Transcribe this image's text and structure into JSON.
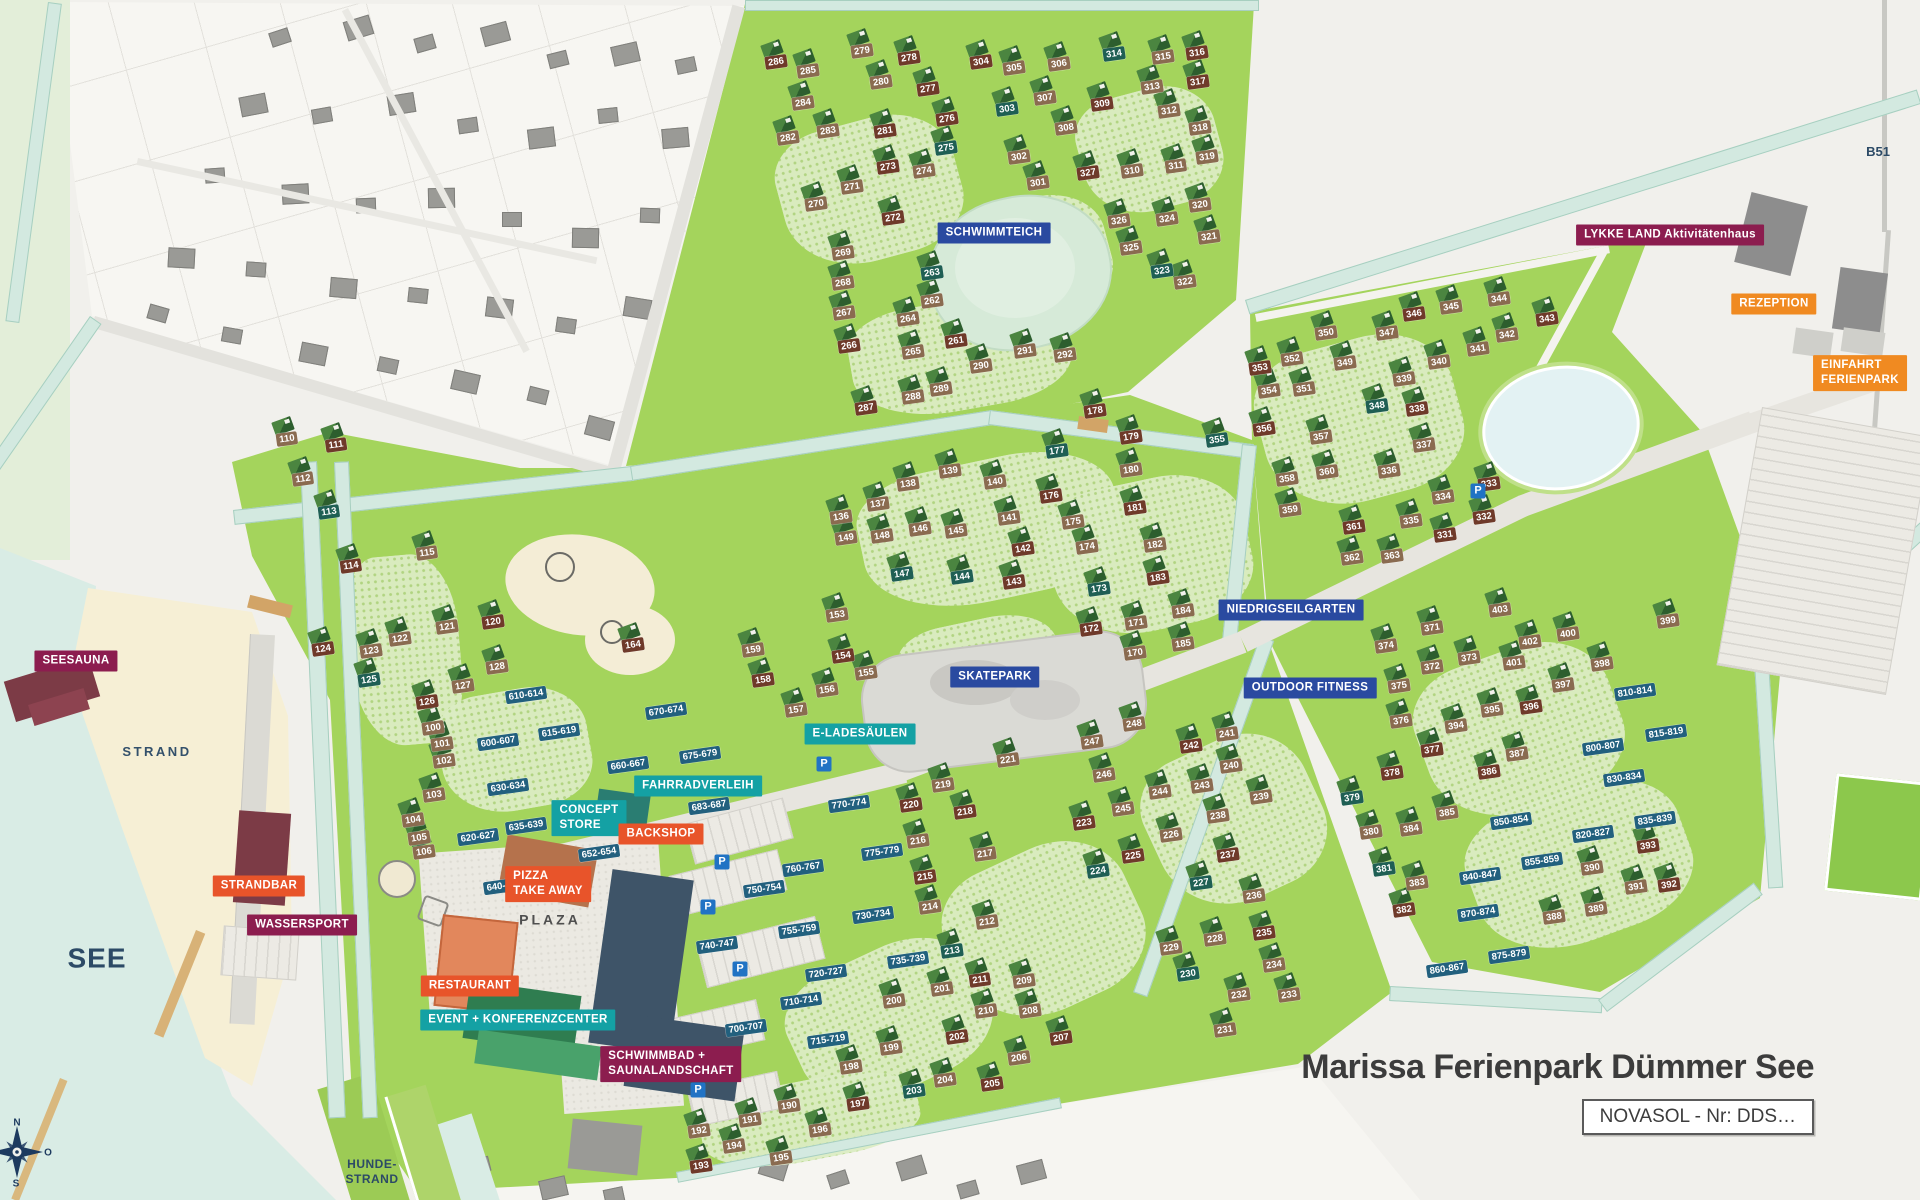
{
  "title": {
    "text": "Marissa Ferienpark Dümmer See"
  },
  "novasol_label": "NOVASOL - Nr: DDS…",
  "compass": {
    "north": "N",
    "east": "O",
    "south": "S"
  },
  "parking_label": "P",
  "colors": {
    "magenta": "#8c1d4f",
    "orange": "#f08a21",
    "red": "#e8542a",
    "teal": "#14a1a4",
    "blue": "#2a4aa0",
    "range_label": "#22607e",
    "house_tan": "#8a6b50",
    "house_redbrown": "#6f3a2a",
    "house_teal": "#1f5f54",
    "park_green": "#a4d45c",
    "water": "#d9ece5",
    "sand": "#f6efd5",
    "navy_text": "#2c4a66"
  },
  "area_labels": [
    {
      "name": "strand",
      "text": "STRAND",
      "x": 157,
      "y": 752,
      "size": 13,
      "ls": 2.5,
      "color": "#33506b"
    },
    {
      "name": "see",
      "text": "SEE",
      "x": 97,
      "y": 958,
      "size": 28,
      "ls": 1,
      "color": "#2c4a66"
    },
    {
      "name": "hunde-strand",
      "text": "HUNDE-\nSTRAND",
      "x": 372,
      "y": 1172,
      "size": 12,
      "ls": 0.5,
      "color": "#2c4a66"
    },
    {
      "name": "plaza",
      "text": "PLAZA",
      "x": 550,
      "y": 920,
      "size": 14,
      "ls": 3,
      "color": "#4f4f4f"
    },
    {
      "name": "b51",
      "text": "B51",
      "x": 1878,
      "y": 152,
      "size": 13,
      "ls": 0,
      "color": "#2c4a66"
    }
  ],
  "facilities": [
    {
      "label": "SEESAUNA",
      "x": 76,
      "y": 661,
      "type": "magenta"
    },
    {
      "label": "STRANDBAR",
      "x": 259,
      "y": 886,
      "type": "red"
    },
    {
      "label": "WASSERSPORT",
      "x": 302,
      "y": 925,
      "type": "magenta"
    },
    {
      "label": "CONCEPT\nSTORE",
      "x": 589,
      "y": 818,
      "type": "teal"
    },
    {
      "label": "BACKSHOP",
      "x": 661,
      "y": 834,
      "type": "red"
    },
    {
      "label": "PIZZA\nTAKE AWAY",
      "x": 548,
      "y": 884,
      "type": "red"
    },
    {
      "label": "RESTAURANT",
      "x": 470,
      "y": 986,
      "type": "red"
    },
    {
      "label": "EVENT + KONFERENZCENTER",
      "x": 518,
      "y": 1020,
      "type": "teal"
    },
    {
      "label": "SCHWIMMBAD +\nSAUNALANDSCHAFT",
      "x": 671,
      "y": 1064,
      "type": "magenta"
    },
    {
      "label": "FAHRRADVERLEIH",
      "x": 698,
      "y": 786,
      "type": "teal"
    },
    {
      "label": "E-LADESÄULEN",
      "x": 860,
      "y": 734,
      "type": "teal"
    },
    {
      "label": "SKATEPARK",
      "x": 995,
      "y": 677,
      "type": "blue"
    },
    {
      "label": "SCHWIMMTEICH",
      "x": 994,
      "y": 233,
      "type": "blue"
    },
    {
      "label": "NIEDRIGSEILGARTEN",
      "x": 1291,
      "y": 610,
      "type": "blue"
    },
    {
      "label": "OUTDOOR FITNESS",
      "x": 1310,
      "y": 688,
      "type": "blue"
    },
    {
      "label": "LYKKE LAND Aktivitätenhaus",
      "x": 1670,
      "y": 235,
      "type": "magenta"
    },
    {
      "label": "REZEPTION",
      "x": 1774,
      "y": 304,
      "type": "orange"
    },
    {
      "label": "EINFAHRT\nFERIENPARK",
      "x": 1860,
      "y": 373,
      "type": "orange"
    }
  ],
  "parking": [
    {
      "x": 824,
      "y": 764
    },
    {
      "x": 722,
      "y": 862
    },
    {
      "x": 708,
      "y": 907
    },
    {
      "x": 740,
      "y": 969
    },
    {
      "x": 698,
      "y": 1090
    },
    {
      "x": 1478,
      "y": 491
    }
  ],
  "ranges": [
    [
      "600-607",
      498,
      742
    ],
    [
      "610-614",
      526,
      695
    ],
    [
      "615-619",
      559,
      732
    ],
    [
      "620-627",
      478,
      837
    ],
    [
      "630-634",
      508,
      787
    ],
    [
      "635-639",
      526,
      826
    ],
    [
      "640-647",
      504,
      886
    ],
    [
      "652-654",
      599,
      853
    ],
    [
      "660-667",
      628,
      765
    ],
    [
      "670-674",
      666,
      711
    ],
    [
      "675-679",
      700,
      755
    ],
    [
      "683-687",
      709,
      806
    ],
    [
      "700-707",
      746,
      1028
    ],
    [
      "710-714",
      801,
      1001
    ],
    [
      "715-719",
      828,
      1040
    ],
    [
      "720-727",
      826,
      973
    ],
    [
      "730-734",
      873,
      915
    ],
    [
      "735-739",
      908,
      960
    ],
    [
      "740-747",
      717,
      945
    ],
    [
      "750-754",
      764,
      889
    ],
    [
      "755-759",
      799,
      930
    ],
    [
      "760-767",
      803,
      868
    ],
    [
      "770-774",
      849,
      804
    ],
    [
      "775-779",
      882,
      852
    ],
    [
      "800-807",
      1603,
      747
    ],
    [
      "810-814",
      1635,
      692
    ],
    [
      "815-819",
      1666,
      733
    ],
    [
      "820-827",
      1593,
      834
    ],
    [
      "830-834",
      1624,
      778
    ],
    [
      "835-839",
      1655,
      820
    ],
    [
      "840-847",
      1480,
      876
    ],
    [
      "850-854",
      1511,
      821
    ],
    [
      "855-859",
      1542,
      861
    ],
    [
      "860-867",
      1447,
      969
    ],
    [
      "870-874",
      1478,
      913
    ],
    [
      "875-879",
      1509,
      955
    ]
  ],
  "houses": [
    [
      "100",
      433,
      728,
      "b"
    ],
    [
      "101",
      442,
      744,
      "b"
    ],
    [
      "102",
      444,
      761,
      "b"
    ],
    [
      "103",
      434,
      795,
      "b"
    ],
    [
      "104",
      413,
      820,
      "b"
    ],
    [
      "105",
      419,
      838,
      "b"
    ],
    [
      "106",
      424,
      852,
      "b"
    ],
    [
      "110",
      287,
      439,
      "b"
    ],
    [
      "111",
      336,
      445,
      "r"
    ],
    [
      "112",
      303,
      479,
      "b"
    ],
    [
      "113",
      329,
      512,
      "t"
    ],
    [
      "114",
      351,
      566,
      "r"
    ],
    [
      "115",
      427,
      553,
      "b"
    ],
    [
      "120",
      493,
      622,
      "r"
    ],
    [
      "121",
      447,
      627,
      "b"
    ],
    [
      "122",
      400,
      639,
      "b"
    ],
    [
      "123",
      371,
      651,
      "b"
    ],
    [
      "124",
      323,
      649,
      "r"
    ],
    [
      "125",
      369,
      680,
      "t"
    ],
    [
      "126",
      427,
      702,
      "r"
    ],
    [
      "127",
      463,
      686,
      "b"
    ],
    [
      "128",
      497,
      667,
      "b"
    ],
    [
      "136",
      841,
      517,
      "b"
    ],
    [
      "137",
      878,
      504,
      "b"
    ],
    [
      "138",
      908,
      484,
      "b"
    ],
    [
      "139",
      950,
      471,
      "b"
    ],
    [
      "140",
      995,
      482,
      "b"
    ],
    [
      "141",
      1009,
      518,
      "b"
    ],
    [
      "142",
      1023,
      549,
      "r"
    ],
    [
      "143",
      1014,
      582,
      "r"
    ],
    [
      "144",
      962,
      577,
      "t"
    ],
    [
      "145",
      956,
      531,
      "b"
    ],
    [
      "146",
      920,
      529,
      "b"
    ],
    [
      "147",
      902,
      574,
      "t"
    ],
    [
      "148",
      882,
      536,
      "b"
    ],
    [
      "149",
      846,
      538,
      "b"
    ],
    [
      "153",
      837,
      615,
      "b"
    ],
    [
      "154",
      843,
      656,
      "r"
    ],
    [
      "155",
      866,
      673,
      "b"
    ],
    [
      "156",
      827,
      690,
      "b"
    ],
    [
      "157",
      796,
      710,
      "b"
    ],
    [
      "158",
      763,
      680,
      "r"
    ],
    [
      "159",
      753,
      650,
      "b"
    ],
    [
      "164",
      633,
      645,
      "r"
    ],
    [
      "170",
      1135,
      653,
      "b"
    ],
    [
      "171",
      1136,
      623,
      "b"
    ],
    [
      "172",
      1091,
      629,
      "r"
    ],
    [
      "173",
      1099,
      589,
      "t"
    ],
    [
      "174",
      1087,
      547,
      "b"
    ],
    [
      "175",
      1073,
      522,
      "b"
    ],
    [
      "176",
      1051,
      496,
      "r"
    ],
    [
      "177",
      1057,
      451,
      "t"
    ],
    [
      "178",
      1095,
      411,
      "r"
    ],
    [
      "179",
      1131,
      437,
      "r"
    ],
    [
      "180",
      1131,
      470,
      "b"
    ],
    [
      "181",
      1135,
      508,
      "r"
    ],
    [
      "182",
      1155,
      545,
      "b"
    ],
    [
      "183",
      1158,
      578,
      "r"
    ],
    [
      "184",
      1183,
      611,
      "b"
    ],
    [
      "185",
      1183,
      644,
      "b"
    ],
    [
      "190",
      789,
      1106,
      "b"
    ],
    [
      "191",
      750,
      1120,
      "b"
    ],
    [
      "192",
      699,
      1131,
      "b"
    ],
    [
      "193",
      701,
      1166,
      "r"
    ],
    [
      "194",
      734,
      1146,
      "b"
    ],
    [
      "195",
      781,
      1158,
      "b"
    ],
    [
      "196",
      820,
      1130,
      "b"
    ],
    [
      "197",
      858,
      1104,
      "r"
    ],
    [
      "198",
      851,
      1067,
      "b"
    ],
    [
      "199",
      891,
      1048,
      "b"
    ],
    [
      "200",
      894,
      1001,
      "b"
    ],
    [
      "201",
      942,
      989,
      "b"
    ],
    [
      "202",
      957,
      1037,
      "r"
    ],
    [
      "203",
      914,
      1091,
      "t"
    ],
    [
      "204",
      945,
      1080,
      "b"
    ],
    [
      "205",
      992,
      1084,
      "r"
    ],
    [
      "206",
      1019,
      1058,
      "b"
    ],
    [
      "207",
      1061,
      1038,
      "r"
    ],
    [
      "208",
      1030,
      1011,
      "b"
    ],
    [
      "209",
      1024,
      981,
      "b"
    ],
    [
      "210",
      986,
      1011,
      "b"
    ],
    [
      "211",
      980,
      980,
      "r"
    ],
    [
      "212",
      987,
      922,
      "b"
    ],
    [
      "213",
      952,
      951,
      "t"
    ],
    [
      "214",
      930,
      907,
      "b"
    ],
    [
      "215",
      925,
      877,
      "r"
    ],
    [
      "216",
      918,
      841,
      "b"
    ],
    [
      "217",
      985,
      854,
      "b"
    ],
    [
      "218",
      965,
      812,
      "r"
    ],
    [
      "219",
      943,
      785,
      "b"
    ],
    [
      "220",
      911,
      805,
      "r"
    ],
    [
      "221",
      1008,
      760,
      "b"
    ],
    [
      "223",
      1084,
      823,
      "r"
    ],
    [
      "224",
      1098,
      871,
      "t"
    ],
    [
      "225",
      1133,
      856,
      "r"
    ],
    [
      "226",
      1171,
      835,
      "b"
    ],
    [
      "227",
      1201,
      883,
      "t"
    ],
    [
      "228",
      1215,
      939,
      "b"
    ],
    [
      "229",
      1171,
      948,
      "b"
    ],
    [
      "230",
      1188,
      974,
      "t"
    ],
    [
      "231",
      1225,
      1030,
      "b"
    ],
    [
      "232",
      1239,
      995,
      "b"
    ],
    [
      "233",
      1289,
      995,
      "b"
    ],
    [
      "234",
      1274,
      965,
      "b"
    ],
    [
      "235",
      1264,
      933,
      "r"
    ],
    [
      "236",
      1254,
      896,
      "b"
    ],
    [
      "237",
      1228,
      855,
      "r"
    ],
    [
      "238",
      1218,
      816,
      "b"
    ],
    [
      "239",
      1261,
      797,
      "b"
    ],
    [
      "240",
      1231,
      766,
      "b"
    ],
    [
      "241",
      1227,
      734,
      "b"
    ],
    [
      "242",
      1191,
      746,
      "r"
    ],
    [
      "243",
      1202,
      786,
      "b"
    ],
    [
      "244",
      1160,
      792,
      "b"
    ],
    [
      "245",
      1123,
      809,
      "b"
    ],
    [
      "246",
      1104,
      775,
      "b"
    ],
    [
      "247",
      1092,
      742,
      "b"
    ],
    [
      "248",
      1134,
      724,
      "b"
    ],
    [
      "261",
      956,
      341,
      "r"
    ],
    [
      "262",
      932,
      301,
      "b"
    ],
    [
      "263",
      932,
      273,
      "t"
    ],
    [
      "264",
      908,
      319,
      "b"
    ],
    [
      "265",
      913,
      352,
      "b"
    ],
    [
      "266",
      849,
      346,
      "r"
    ],
    [
      "267",
      844,
      313,
      "b"
    ],
    [
      "268",
      843,
      283,
      "b"
    ],
    [
      "269",
      843,
      253,
      "b"
    ],
    [
      "270",
      816,
      204,
      "b"
    ],
    [
      "271",
      852,
      187,
      "b"
    ],
    [
      "272",
      893,
      218,
      "r"
    ],
    [
      "273",
      888,
      167,
      "r"
    ],
    [
      "274",
      924,
      171,
      "b"
    ],
    [
      "275",
      946,
      148,
      "t"
    ],
    [
      "276",
      947,
      119,
      "r"
    ],
    [
      "277",
      928,
      89,
      "r"
    ],
    [
      "278",
      909,
      58,
      "r"
    ],
    [
      "279",
      862,
      51,
      "b"
    ],
    [
      "280",
      881,
      82,
      "b"
    ],
    [
      "281",
      885,
      131,
      "r"
    ],
    [
      "282",
      788,
      138,
      "b"
    ],
    [
      "283",
      828,
      131,
      "b"
    ],
    [
      "284",
      803,
      103,
      "b"
    ],
    [
      "285",
      808,
      71,
      "b"
    ],
    [
      "286",
      776,
      62,
      "r"
    ],
    [
      "287",
      866,
      408,
      "r"
    ],
    [
      "288",
      913,
      397,
      "b"
    ],
    [
      "289",
      941,
      389,
      "b"
    ],
    [
      "290",
      981,
      366,
      "b"
    ],
    [
      "291",
      1025,
      351,
      "b"
    ],
    [
      "292",
      1065,
      355,
      "b"
    ],
    [
      "301",
      1038,
      183,
      "b"
    ],
    [
      "302",
      1019,
      157,
      "b"
    ],
    [
      "303",
      1007,
      109,
      "t"
    ],
    [
      "304",
      981,
      62,
      "r"
    ],
    [
      "305",
      1014,
      68,
      "b"
    ],
    [
      "306",
      1059,
      64,
      "b"
    ],
    [
      "307",
      1045,
      98,
      "b"
    ],
    [
      "308",
      1066,
      128,
      "b"
    ],
    [
      "309",
      1102,
      104,
      "r"
    ],
    [
      "310",
      1132,
      171,
      "b"
    ],
    [
      "311",
      1176,
      166,
      "b"
    ],
    [
      "312",
      1169,
      111,
      "b"
    ],
    [
      "313",
      1152,
      87,
      "b"
    ],
    [
      "314",
      1114,
      54,
      "t"
    ],
    [
      "315",
      1163,
      57,
      "b"
    ],
    [
      "316",
      1197,
      53,
      "r"
    ],
    [
      "317",
      1198,
      82,
      "r"
    ],
    [
      "318",
      1200,
      128,
      "b"
    ],
    [
      "319",
      1207,
      157,
      "b"
    ],
    [
      "320",
      1200,
      205,
      "b"
    ],
    [
      "321",
      1209,
      237,
      "b"
    ],
    [
      "322",
      1185,
      282,
      "b"
    ],
    [
      "323",
      1162,
      271,
      "t"
    ],
    [
      "324",
      1167,
      219,
      "b"
    ],
    [
      "325",
      1131,
      248,
      "b"
    ],
    [
      "326",
      1119,
      221,
      "b"
    ],
    [
      "327",
      1088,
      173,
      "r"
    ],
    [
      "331",
      1445,
      535,
      "r"
    ],
    [
      "332",
      1484,
      517,
      "r"
    ],
    [
      "333",
      1489,
      484,
      "r"
    ],
    [
      "334",
      1443,
      497,
      "b"
    ],
    [
      "335",
      1411,
      521,
      "b"
    ],
    [
      "336",
      1389,
      471,
      "b"
    ],
    [
      "337",
      1424,
      445,
      "b"
    ],
    [
      "338",
      1417,
      409,
      "r"
    ],
    [
      "339",
      1404,
      379,
      "b"
    ],
    [
      "340",
      1439,
      362,
      "b"
    ],
    [
      "341",
      1478,
      349,
      "b"
    ],
    [
      "342",
      1507,
      335,
      "b"
    ],
    [
      "343",
      1547,
      319,
      "r"
    ],
    [
      "344",
      1499,
      299,
      "b"
    ],
    [
      "345",
      1451,
      307,
      "b"
    ],
    [
      "346",
      1414,
      314,
      "r"
    ],
    [
      "347",
      1387,
      333,
      "b"
    ],
    [
      "348",
      1377,
      406,
      "t"
    ],
    [
      "349",
      1345,
      363,
      "b"
    ],
    [
      "350",
      1326,
      333,
      "b"
    ],
    [
      "351",
      1304,
      389,
      "b"
    ],
    [
      "352",
      1292,
      359,
      "b"
    ],
    [
      "353",
      1260,
      368,
      "r"
    ],
    [
      "354",
      1269,
      391,
      "b"
    ],
    [
      "355",
      1217,
      440,
      "t"
    ],
    [
      "356",
      1264,
      429,
      "r"
    ],
    [
      "357",
      1321,
      437,
      "b"
    ],
    [
      "358",
      1287,
      479,
      "b"
    ],
    [
      "359",
      1290,
      510,
      "b"
    ],
    [
      "360",
      1327,
      472,
      "b"
    ],
    [
      "361",
      1354,
      527,
      "r"
    ],
    [
      "362",
      1352,
      558,
      "b"
    ],
    [
      "363",
      1392,
      556,
      "b"
    ],
    [
      "371",
      1432,
      628,
      "b"
    ],
    [
      "372",
      1432,
      667,
      "b"
    ],
    [
      "373",
      1469,
      658,
      "b"
    ],
    [
      "374",
      1386,
      646,
      "b"
    ],
    [
      "375",
      1399,
      686,
      "b"
    ],
    [
      "376",
      1401,
      721,
      "b"
    ],
    [
      "377",
      1432,
      750,
      "r"
    ],
    [
      "378",
      1392,
      773,
      "r"
    ],
    [
      "379",
      1352,
      798,
      "t"
    ],
    [
      "380",
      1371,
      832,
      "b"
    ],
    [
      "381",
      1384,
      869,
      "t"
    ],
    [
      "382",
      1404,
      910,
      "r"
    ],
    [
      "383",
      1417,
      883,
      "b"
    ],
    [
      "384",
      1411,
      829,
      "b"
    ],
    [
      "385",
      1447,
      813,
      "b"
    ],
    [
      "386",
      1489,
      772,
      "r"
    ],
    [
      "387",
      1517,
      754,
      "b"
    ],
    [
      "388",
      1554,
      917,
      "b"
    ],
    [
      "389",
      1596,
      909,
      "b"
    ],
    [
      "390",
      1592,
      868,
      "b"
    ],
    [
      "391",
      1636,
      887,
      "b"
    ],
    [
      "392",
      1669,
      885,
      "r"
    ],
    [
      "393",
      1648,
      846,
      "r"
    ],
    [
      "394",
      1456,
      726,
      "b"
    ],
    [
      "395",
      1492,
      710,
      "b"
    ],
    [
      "396",
      1531,
      707,
      "r"
    ],
    [
      "397",
      1563,
      685,
      "b"
    ],
    [
      "398",
      1602,
      664,
      "b"
    ],
    [
      "399",
      1668,
      621,
      "b"
    ],
    [
      "400",
      1568,
      634,
      "b"
    ],
    [
      "401",
      1514,
      663,
      "b"
    ],
    [
      "402",
      1530,
      642,
      "b"
    ],
    [
      "403",
      1500,
      610,
      "b"
    ]
  ]
}
